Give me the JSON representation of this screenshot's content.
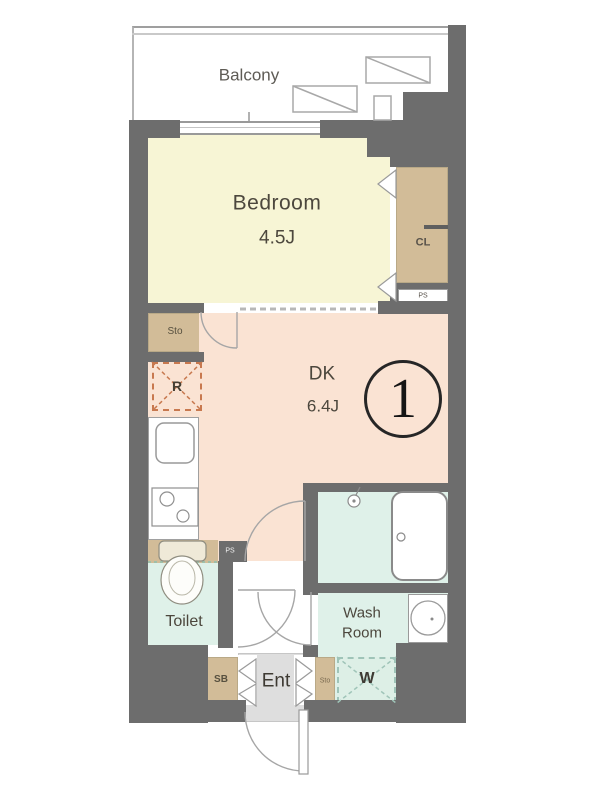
{
  "floorplan": {
    "unit_number": "1",
    "rooms": {
      "balcony": {
        "label": "Balcony"
      },
      "bedroom": {
        "label": "Bedroom",
        "size": "4.5J"
      },
      "dk": {
        "label": "DK",
        "size": "6.4J"
      },
      "closet": {
        "label": "CL"
      },
      "pipe_space_upper": {
        "label": "PS"
      },
      "storage_hall": {
        "label": "Sto"
      },
      "refrigerator_space": {
        "label": "R"
      },
      "pipe_space_kitchen": {
        "label": "PS"
      },
      "toilet": {
        "label": "Toilet"
      },
      "wash_room": {
        "label_line1": "Wash",
        "label_line2": "Room"
      },
      "washer_space": {
        "label": "W"
      },
      "shoe_box": {
        "label": "SB"
      },
      "entrance": {
        "label": "Ent"
      },
      "storage_entrance": {
        "label": "Sto"
      }
    },
    "colors": {
      "wall": "#6d6d6d",
      "bedroom": "#f7f5d5",
      "dk": "#fae3d3",
      "tan": "#d2bc98",
      "mint": "#dff1e9",
      "washer_mint": "#ddefe6",
      "entrance_floor": "#dedede",
      "fridge_dash": "#c8794f",
      "washer_dash": "#9fc4b8",
      "line": "#9a9a9a",
      "text": "#4c473d"
    }
  }
}
